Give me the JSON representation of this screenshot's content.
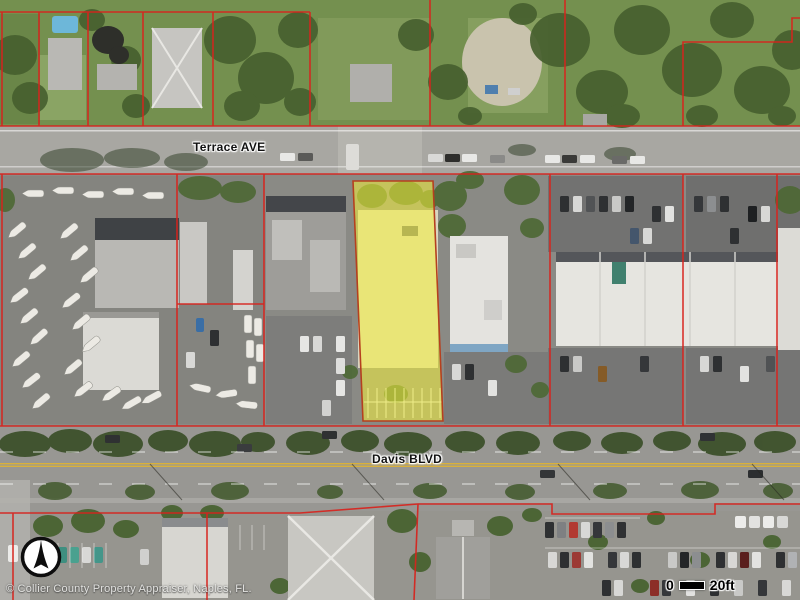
{
  "streets": {
    "terrace": "Terrace AVE",
    "davis": "Davis BLVD"
  },
  "attribution": "© Collier County Property Appraiser, Naples, FL.",
  "scale_bar": {
    "start": "0",
    "end": "20ft"
  },
  "icons": {
    "north_arrow": "north-arrow"
  },
  "colors": {
    "parcel_line": "#d8231d",
    "highlight_fill": "#f5f23a",
    "highlight_outline": "#b5401f",
    "road_center_line": "#d9b13b"
  }
}
